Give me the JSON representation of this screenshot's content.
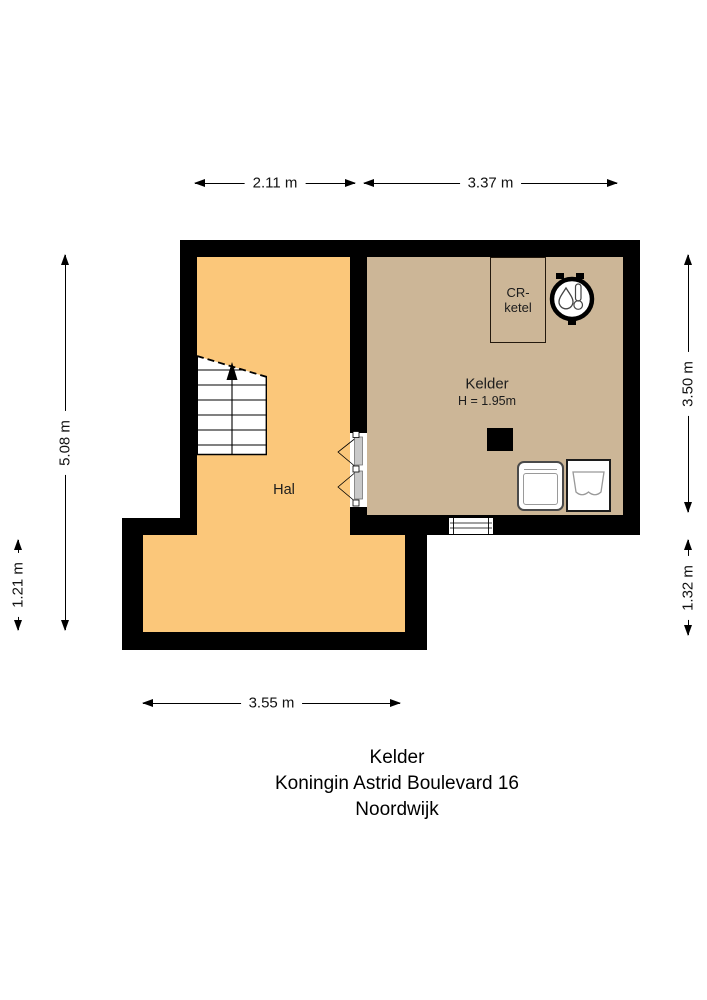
{
  "dimensions": {
    "top_left": "2.11 m",
    "top_right": "3.37 m",
    "left_main": "5.08 m",
    "left_lower": "1.21 m",
    "right_main": "3.50 m",
    "right_lower": "1.32 m",
    "bottom": "3.55 m"
  },
  "rooms": {
    "hal": {
      "label": "Hal",
      "fill": "#FBC77A"
    },
    "kelder": {
      "label": "Kelder",
      "ceiling_height": "H = 1.95m",
      "fill": "#CCB697"
    }
  },
  "fixtures": {
    "cr_ketel_line1": "CR-",
    "cr_ketel_line2": "ketel"
  },
  "footer": {
    "floor": "Kelder",
    "address": "Koningin Astrid Boulevard 16",
    "city": "Noordwijk"
  },
  "colors": {
    "wall": "#000000",
    "hal_fill": "#FBC77A",
    "kelder_fill": "#CCB697",
    "background": "#FFFFFF"
  }
}
